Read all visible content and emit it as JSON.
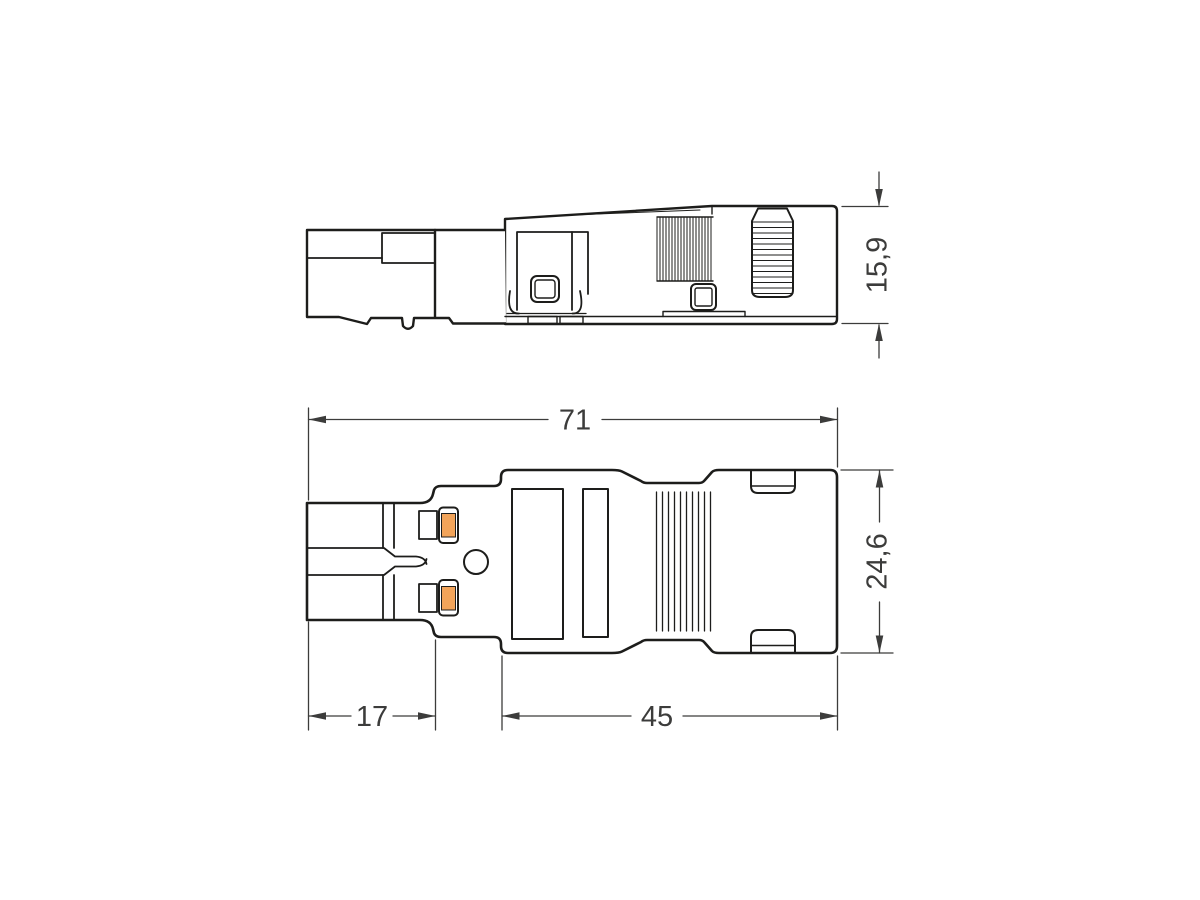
{
  "page": {
    "background_color": "#ffffff"
  },
  "drawing": {
    "outline_color": "#1d1d1b",
    "dimension_line_color": "#3c3c3b",
    "accent_color": "#F2A45A",
    "views": {
      "side_view": {
        "dimensions": {
          "height": {
            "label": "15,9"
          }
        }
      },
      "top_view": {
        "dimensions": {
          "overall_length": {
            "label": "71"
          },
          "width": {
            "label": "24,6"
          },
          "front_length": {
            "label": "17"
          },
          "body_length": {
            "label": "45"
          }
        }
      }
    }
  }
}
